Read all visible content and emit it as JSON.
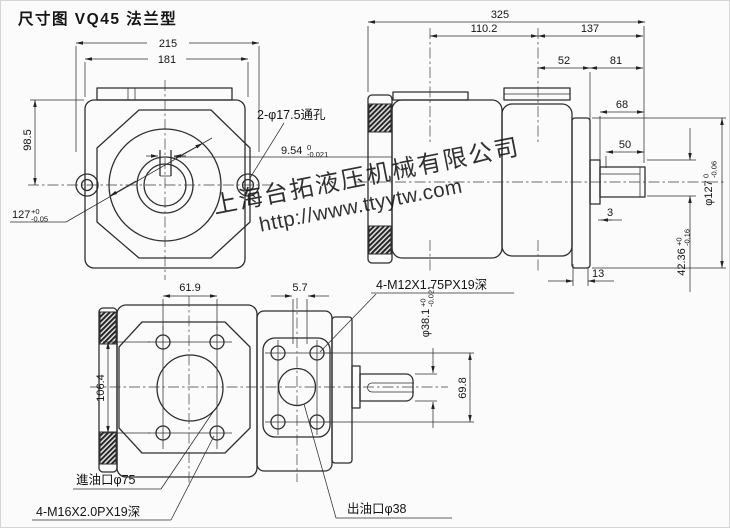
{
  "title": "尺寸图 VQ45 法兰型",
  "colors": {
    "line": "#2e2e2e",
    "background": "#fbfbfb",
    "watermark_blue": "#4a74e8"
  },
  "watermark": {
    "company": "上海台拓液压机械有限公司",
    "url": "http://www.ttyytw.com"
  },
  "front_view": {
    "overall_width": "215",
    "inner_width": "181",
    "height_to_center": "98.5",
    "pilot_dia": {
      "value": "127",
      "sup": "+0",
      "sub": "-0.05"
    },
    "through_holes": "2-φ17.5通孔",
    "key_width": {
      "value": "9.54",
      "sup": "0",
      "sub": "-0.021"
    }
  },
  "side_view": {
    "overall_length": "325",
    "len_110_2": "110.2",
    "len_137": "137",
    "len_52": "52",
    "len_81": "81",
    "len_68": "68",
    "len_50": "50",
    "len_3": "3",
    "len_13": "13",
    "flange_dia": {
      "value": "φ127",
      "sup": "0",
      "sub": "-0.06"
    },
    "key_height": {
      "value": "42.36",
      "sup": "+0",
      "sub": "-0.16"
    }
  },
  "bottom_view": {
    "hole_span_x": "61.9",
    "offset_5_7": "5.7",
    "hole_span_y": "106.4",
    "port_hole_span": "69.8",
    "shaft_dia": {
      "value": "φ38.1",
      "sup": "+0",
      "sub": "-0.021"
    },
    "outlet_thread": "4-M12X1.75PX19深",
    "inlet_port": "進油口φ75",
    "inlet_thread": "4-M16X2.0PX19深",
    "outlet_port": "出油口φ38"
  }
}
